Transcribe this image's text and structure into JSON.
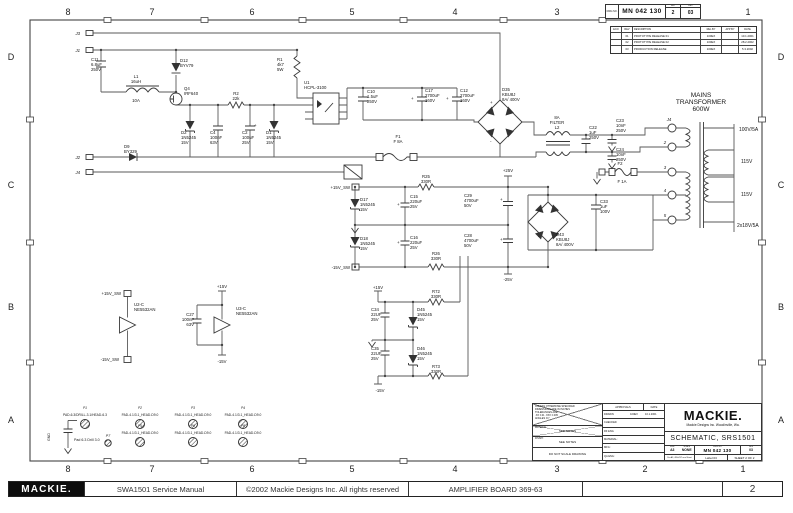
{
  "doc": {
    "dwg_label": "DWG NO.",
    "dwg_no": "MN 042 130",
    "sht_label": "SHT",
    "sht": "2",
    "rev_label": "REV",
    "rev": "03"
  },
  "rev_table": {
    "headers": [
      "ECO",
      "REV",
      "DESCRIPTION",
      "REL BY",
      "APP BY",
      "DATE"
    ],
    "rows": [
      {
        "eco": "",
        "rev": "01",
        "desc": "PROTOTYPE RELEASE 01",
        "rel": "100EX",
        "app": "",
        "date": "10.1.2001"
      },
      {
        "eco": "",
        "rev": "02",
        "desc": "PROTOTYPE RELEASE 02",
        "rel": "100EX",
        "app": "",
        "date": "28.2.2002"
      },
      {
        "eco": "",
        "rev": "03",
        "desc": "PRODUCTION RELEASE",
        "rel": "100EX",
        "app": "",
        "date": "5.3.2002"
      }
    ]
  },
  "zones": {
    "top": [
      "8",
      "7",
      "6",
      "5",
      "4",
      "3",
      "1"
    ],
    "bottom": [
      "8",
      "7",
      "6",
      "5",
      "4",
      "3",
      "2",
      "1"
    ],
    "left": [
      "D",
      "C",
      "B",
      "A"
    ],
    "right": [
      "D",
      "C",
      "B",
      "A"
    ]
  },
  "title_block": {
    "tolerance_note": "UNLESS OTHERWISE SPECIFIED\nDIMENSIONS ARE IN INCHES\nTOLERANCES ARE:\n.XX ±.01   .XXX ±.005\nANGLES ±1°",
    "material_label": "MATERIAL:",
    "material": "SEE NOTES",
    "finish_label": "FINISH:",
    "finish": "SEE NOTES",
    "no_scale": "DO NOT SCALE DRAWING",
    "approvals_label": "APPROVALS",
    "date_label": "DATE",
    "rows": [
      {
        "k": "DRAWN",
        "v": "100EX",
        "d": "10.1.2001"
      },
      {
        "k": "CHECKED",
        "v": "",
        "d": ""
      },
      {
        "k": "RF ENG",
        "v": "",
        "d": ""
      },
      {
        "k": "MATERIAL:",
        "v": "",
        "d": ""
      },
      {
        "k": "MFG:",
        "v": "",
        "d": ""
      },
      {
        "k": "QA ENG:",
        "v": "",
        "d": ""
      }
    ],
    "logo": "MACKIE.",
    "logo_sub": "Mackie Designs Inc.  Woodinville, Wa.",
    "title": "SCHEMATIC, SRS1501",
    "size_label": "SIZE",
    "size": "A3",
    "scale_label": "SCALE",
    "scale": "NONE",
    "dwgno_label": "DWG NO.",
    "dwg_no": "MN 042 130",
    "rev_label": "REV",
    "rev": "03",
    "sheet_note": "Din A3, 420x297 mm Sheet",
    "label": "Label 03",
    "sheet": "SHEET 2 OF 2"
  },
  "footer": {
    "logo": "MACKIE.",
    "manual": "SWA1501 Service Manual",
    "copyright": "©2002 Mackie Designs Inc. All rights reserved",
    "board": "AMPLIFIER BOARD 369-63",
    "page": "2"
  },
  "schematic": {
    "labels": [
      {
        "x": 80,
        "y": 35,
        "a": "end",
        "i": 1,
        "t": "J3"
      },
      {
        "x": 80,
        "y": 52,
        "a": "end",
        "i": 1,
        "t": "J1"
      },
      {
        "x": 80,
        "y": 159,
        "a": "end",
        "i": 1,
        "t": "J2"
      },
      {
        "x": 80,
        "y": 174,
        "a": "end",
        "i": 1,
        "t": "J4"
      },
      {
        "x": 91,
        "y": 61,
        "t": "C11\n6.8uF\n250V"
      },
      {
        "x": 136,
        "y": 78,
        "a": "middle",
        "t": "L1\n16uH"
      },
      {
        "x": 136,
        "y": 102,
        "a": "middle",
        "t": "10A"
      },
      {
        "x": 180,
        "y": 62,
        "t": "D12\nBYV79"
      },
      {
        "x": 124,
        "y": 148,
        "t": "D9\nBY329"
      },
      {
        "x": 184,
        "y": 90,
        "t": "Q4\nIRF640"
      },
      {
        "x": 181,
        "y": 134,
        "t": "D2\n1N5245\n15V"
      },
      {
        "x": 210,
        "y": 134,
        "t": "C4\n100nF\n63V"
      },
      {
        "x": 242,
        "y": 134,
        "t": "C2\n100uF\n25V"
      },
      {
        "x": 266,
        "y": 134,
        "t": "D1\n1N5245\n15V"
      },
      {
        "x": 236,
        "y": 95,
        "a": "middle",
        "t": "R2\n22k"
      },
      {
        "x": 277,
        "y": 61,
        "t": "R1\n4k7\n5W"
      },
      {
        "x": 304,
        "y": 84,
        "t": "U1\nHCPL-3100"
      },
      {
        "x": 367,
        "y": 93,
        "t": "C10\n1.5uF\n250V"
      },
      {
        "x": 425,
        "y": 92,
        "t": "C17\n2700uF\n160V"
      },
      {
        "x": 460,
        "y": 92,
        "t": "C12\n2700uF\n160V"
      },
      {
        "x": 398,
        "y": 138,
        "a": "middle",
        "t": "F1\nF 8A"
      },
      {
        "x": 502,
        "y": 91,
        "t": "D35\nKBU8J\n8A/ 400V"
      },
      {
        "x": 557,
        "y": 119,
        "a": "middle",
        "t": "8A\nFILTER\nL2"
      },
      {
        "x": 589,
        "y": 129,
        "t": "C22\n1uF\n250V"
      },
      {
        "x": 616,
        "y": 122,
        "t": "C23\n10nF\n250V"
      },
      {
        "x": 616,
        "y": 151,
        "t": "C24\n10nF\n250V"
      },
      {
        "x": 620,
        "y": 165,
        "a": "middle",
        "t": "F2"
      },
      {
        "x": 622,
        "y": 183,
        "a": "middle",
        "t": "F 1A"
      },
      {
        "x": 701,
        "y": 97,
        "a": "middle",
        "fs": 6.5,
        "t": "MAINS\nTRANSFORMER\n600W"
      },
      {
        "x": 739,
        "y": 131,
        "fs": 5,
        "t": "100V/5A"
      },
      {
        "x": 741,
        "y": 163,
        "fs": 5,
        "t": "115V"
      },
      {
        "x": 741,
        "y": 196,
        "fs": 5,
        "t": "115V"
      },
      {
        "x": 737,
        "y": 227,
        "fs": 5,
        "t": "2x18V/5A"
      },
      {
        "x": 669,
        "y": 121,
        "a": "middle",
        "i": 1,
        "t": "J4"
      },
      {
        "x": 665,
        "y": 144,
        "a": "middle",
        "i": 1,
        "t": "2"
      },
      {
        "x": 665,
        "y": 169,
        "a": "middle",
        "i": 1,
        "t": "3"
      },
      {
        "x": 665,
        "y": 192,
        "a": "middle",
        "i": 1,
        "t": "4"
      },
      {
        "x": 665,
        "y": 217,
        "a": "middle",
        "i": 1,
        "t": "5"
      },
      {
        "x": 350,
        "y": 189,
        "a": "end",
        "t": "+15V_SW"
      },
      {
        "x": 350,
        "y": 269,
        "a": "end",
        "t": "-15V_SW"
      },
      {
        "x": 360,
        "y": 201,
        "t": "D17\n1N5245\n15V"
      },
      {
        "x": 360,
        "y": 240,
        "t": "D18\n1N5245\n15V"
      },
      {
        "x": 410,
        "y": 198,
        "t": "C15\n220uF\n25V"
      },
      {
        "x": 410,
        "y": 239,
        "t": "C16\n220uF\n25V"
      },
      {
        "x": 426,
        "y": 178,
        "a": "middle",
        "t": "R25\n330R"
      },
      {
        "x": 436,
        "y": 255,
        "a": "middle",
        "t": "R26\n330R"
      },
      {
        "x": 508,
        "y": 172,
        "a": "middle",
        "t": "+25V"
      },
      {
        "x": 508,
        "y": 281,
        "a": "middle",
        "t": "-25V"
      },
      {
        "x": 464,
        "y": 197,
        "t": "C29\n4700uF\n50V"
      },
      {
        "x": 464,
        "y": 237,
        "t": "C28\n4700uF\n50V"
      },
      {
        "x": 600,
        "y": 203,
        "t": "C33\n1uF\n100V"
      },
      {
        "x": 556,
        "y": 236,
        "t": "D43\nKBU8J\n8A/ 400V"
      },
      {
        "x": 378,
        "y": 289,
        "a": "middle",
        "t": "+15V"
      },
      {
        "x": 380,
        "y": 392,
        "a": "middle",
        "t": "-15V"
      },
      {
        "x": 371,
        "y": 311,
        "t": "C34\n22UF\n25V"
      },
      {
        "x": 371,
        "y": 350,
        "t": "C35\n22UF\n25V"
      },
      {
        "x": 417,
        "y": 311,
        "t": "D45\n1N5245\n15V"
      },
      {
        "x": 417,
        "y": 350,
        "t": "D46\n1N5245\n15V"
      },
      {
        "x": 436,
        "y": 293,
        "a": "middle",
        "t": "R72\n330R"
      },
      {
        "x": 436,
        "y": 368,
        "a": "middle",
        "t": "R73\n330R"
      },
      {
        "x": 121,
        "y": 295,
        "a": "end",
        "t": "+15V_SW"
      },
      {
        "x": 119,
        "y": 361,
        "a": "end",
        "t": "-15V_SW"
      },
      {
        "x": 134,
        "y": 306,
        "t": "U2-C\nNE5532AN"
      },
      {
        "x": 222,
        "y": 288,
        "a": "middle",
        "t": "+15V"
      },
      {
        "x": 222,
        "y": 363,
        "a": "middle",
        "t": "-15V"
      },
      {
        "x": 194,
        "y": 316,
        "a": "end",
        "t": "C27\n100nF\n63V"
      },
      {
        "x": 236,
        "y": 310,
        "t": "U3-C\nNE5532AN"
      },
      {
        "x": 50,
        "y": 441,
        "r": -90,
        "fs": 3.6,
        "t": "GND"
      },
      {
        "x": 74,
        "y": 441,
        "fs": 3.6,
        "t": "Pad 6.3 Drill 3.0"
      },
      {
        "x": 108,
        "y": 437,
        "a": "middle",
        "i": 1,
        "fs": 3.6,
        "t": "P7"
      },
      {
        "x": 85,
        "y": 416,
        "a": "middle",
        "fs": 3.3,
        "t": "PAD-6.3/DRILL-3.1/HEAD-6.3"
      },
      {
        "x": 140,
        "y": 416,
        "a": "middle",
        "fs": 3.3,
        "t": "PAD-4.1/3.1_HEAD-D9.0"
      },
      {
        "x": 193,
        "y": 416,
        "a": "middle",
        "fs": 3.3,
        "t": "PAD-4.1/3.1_HEAD-D9.0"
      },
      {
        "x": 243,
        "y": 416,
        "a": "middle",
        "fs": 3.3,
        "t": "PAD-4.1/3.1_HEAD-D9.0"
      },
      {
        "x": 140,
        "y": 434,
        "a": "middle",
        "fs": 3.3,
        "t": "PAD-4.1/3.1_HEAD-D9.0"
      },
      {
        "x": 193,
        "y": 434,
        "a": "middle",
        "fs": 3.3,
        "t": "PAD-4.1/3.1_HEAD-D9.0"
      },
      {
        "x": 243,
        "y": 434,
        "a": "middle",
        "fs": 3.3,
        "t": "PAD-4.1/3.1_HEAD-D9.0"
      },
      {
        "x": 85,
        "y": 409,
        "a": "middle",
        "i": 1,
        "fs": 3.3,
        "t": "P1"
      },
      {
        "x": 140,
        "y": 409,
        "a": "middle",
        "i": 1,
        "fs": 3.3,
        "t": "P2"
      },
      {
        "x": 193,
        "y": 409,
        "a": "middle",
        "i": 1,
        "fs": 3.3,
        "t": "P3"
      },
      {
        "x": 243,
        "y": 409,
        "a": "middle",
        "i": 1,
        "fs": 3.3,
        "t": "P4"
      },
      {
        "x": 140,
        "y": 427,
        "a": "middle",
        "i": 1,
        "fs": 3.3,
        "t": "P5"
      },
      {
        "x": 193,
        "y": 427,
        "a": "middle",
        "i": 1,
        "fs": 3.3,
        "t": "P6"
      },
      {
        "x": 243,
        "y": 427,
        "a": "middle",
        "i": 1,
        "fs": 3.3,
        "t": "P8"
      },
      {
        "x": 254,
        "y": 127,
        "fs": 4.5,
        "t": "+"
      },
      {
        "x": 411,
        "y": 100,
        "fs": 4.5,
        "t": "+"
      },
      {
        "x": 446,
        "y": 100,
        "fs": 4.5,
        "t": "+"
      },
      {
        "x": 397,
        "y": 206,
        "fs": 4.5,
        "t": "+"
      },
      {
        "x": 397,
        "y": 244,
        "fs": 4.5,
        "t": "+"
      },
      {
        "x": 500,
        "y": 201,
        "fs": 4.5,
        "t": "+"
      },
      {
        "x": 500,
        "y": 241,
        "fs": 4.5,
        "t": "+"
      },
      {
        "x": 490,
        "y": 104,
        "fs": 4.5,
        "t": "+"
      },
      {
        "x": 490,
        "y": 143,
        "fs": 4.5,
        "t": "-"
      },
      {
        "x": 538,
        "y": 212,
        "fs": 4.5,
        "t": "+"
      },
      {
        "x": 538,
        "y": 238,
        "fs": 4.5,
        "t": "-"
      }
    ]
  }
}
